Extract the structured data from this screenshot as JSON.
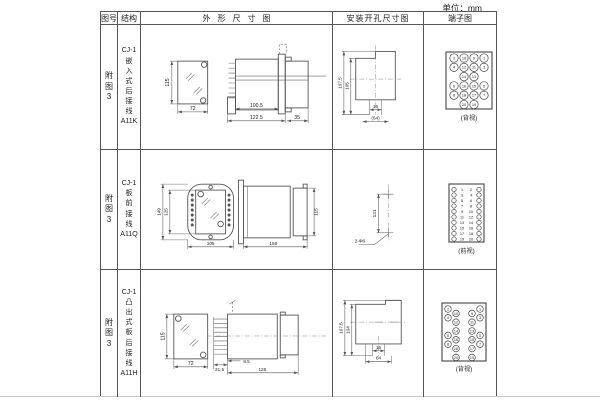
{
  "unit_label": "单位：mm",
  "table": {
    "headers": {
      "fig_no": "图号",
      "structure": "结构",
      "outline": "外形尺寸图",
      "install": "安装开孔尺寸图",
      "terminal": "端子图"
    },
    "rows": [
      {
        "fig_no": "附\n图\n3",
        "structure": "CJ-1\n嵌\n入\n式\n后\n接\n线\nA11K",
        "outline": {
          "front_h": "115",
          "front_w": "72",
          "side_d1": "100.5",
          "side_d2": "122.5",
          "side_d3": "35"
        },
        "install": {
          "dim_outer": "107.5",
          "dim_inner": "105",
          "dim_tab": "16",
          "dim_width": "(64)"
        },
        "terminal": {
          "type": "grid",
          "caption": "(背视)",
          "rows": [
            [
              "2",
              "10",
              "9",
              "1"
            ],
            [
              "4",
              "12",
              "11",
              "3"
            ],
            [
              "",
              "14",
              "13",
              ""
            ],
            [
              "6",
              "16",
              "15",
              "5"
            ],
            [
              "8",
              "18",
              "17",
              "7"
            ],
            [
              "",
              "20",
              "19",
              ""
            ]
          ]
        }
      },
      {
        "fig_no": "附\n图\n3",
        "structure": "CJ-1\n板\n前\n接\n线\nA11Q",
        "outline": {
          "front_h1": "149",
          "front_h2": "125",
          "front_w": "105",
          "side_l": "156",
          "side_h": "115"
        },
        "install": {
          "dim_v": "131",
          "hole_label": "2-Φ6"
        },
        "terminal": {
          "type": "pairs",
          "caption": "(前视)",
          "left": [
            "1",
            "3",
            "5",
            "7",
            "9",
            "11",
            "13",
            "15",
            "17",
            "19"
          ],
          "right": [
            "2",
            "4",
            "6",
            "8",
            "10",
            "12",
            "14",
            "16",
            "18",
            "20"
          ]
        }
      },
      {
        "fig_no": "附\n图\n3",
        "structure": "CJ-1\n凸\n出\n式\n板\n后\n接\n线\nA11H",
        "outline": {
          "front_h": "115",
          "front_w": "72",
          "side_d1": "31.5",
          "side_d2": "9.5",
          "side_d3": "126"
        },
        "install": {
          "dim_outer": "107.5",
          "dim_inner": "104",
          "dim_tab": "16",
          "dim_width": "64"
        },
        "terminal": {
          "type": "staggered",
          "caption": "(背视)",
          "rows": [
            [
              "2",
              "10",
              "9",
              "1"
            ],
            [
              "4",
              "12",
              "11",
              "3"
            ],
            [
              "",
              "14",
              "13",
              ""
            ],
            [
              "6",
              "16",
              "15",
              "5"
            ],
            [
              "8",
              "18",
              "17",
              "7"
            ],
            [
              "",
              "20",
              "19",
              ""
            ]
          ]
        }
      }
    ]
  }
}
